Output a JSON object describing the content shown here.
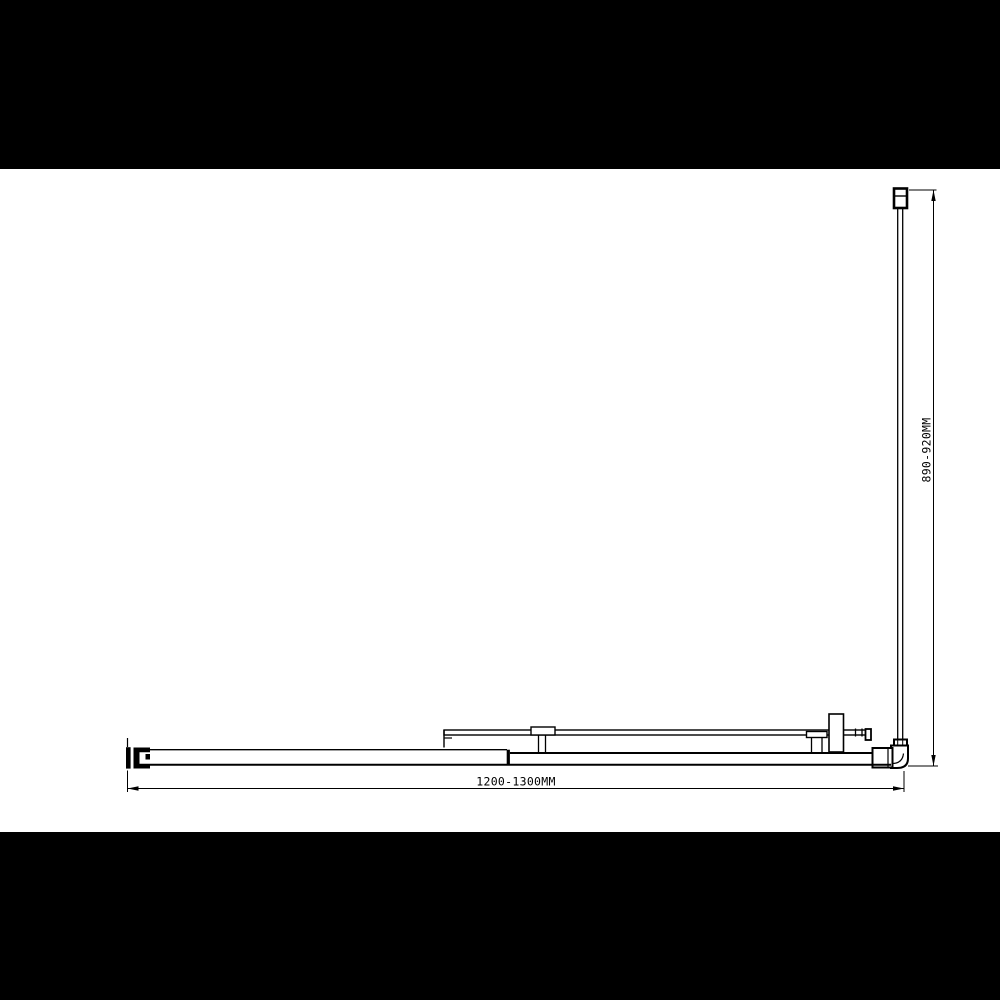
{
  "canvas": {
    "background_color": "#ffffff",
    "letterbox_color": "#000000",
    "line_color": "#000000"
  },
  "drawing": {
    "type": "technical-plan-drawing",
    "labels": {
      "width_dimension": "1200-1300MM",
      "height_dimension": "890-920MM"
    }
  }
}
